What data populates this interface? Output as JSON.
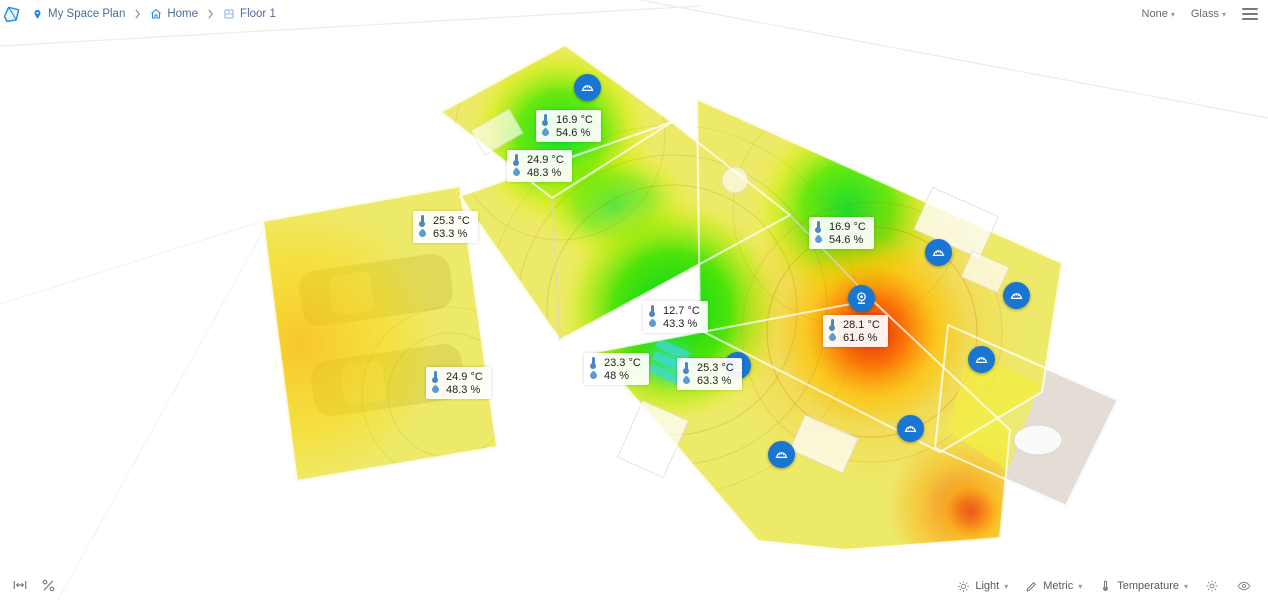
{
  "breadcrumb": {
    "items": [
      {
        "icon": "location-pin-icon",
        "label": "My Space Plan"
      },
      {
        "icon": "home-icon",
        "label": "Home"
      },
      {
        "icon": "floor-icon",
        "label": "Floor 1"
      }
    ]
  },
  "view_controls": {
    "none_dropdown": "None",
    "glass_dropdown": "Glass"
  },
  "toolbar": {
    "light_dropdown": "Light",
    "metric_dropdown": "Metric",
    "temperature_dropdown": "Temperature"
  },
  "sensors": [
    {
      "temperature": "16.9 °C",
      "humidity": "54.6 %",
      "x": 536,
      "y": 110
    },
    {
      "temperature": "24.9 °C",
      "humidity": "48.3 %",
      "x": 507,
      "y": 150
    },
    {
      "temperature": "25.3 °C",
      "humidity": "63.3 %",
      "x": 413,
      "y": 211
    },
    {
      "temperature": "16.9 °C",
      "humidity": "54.6 %",
      "x": 809,
      "y": 217
    },
    {
      "temperature": "12.7 °C",
      "humidity": "43.3 %",
      "x": 643,
      "y": 301
    },
    {
      "temperature": "28.1 °C",
      "humidity": "61.6 %",
      "x": 823,
      "y": 315
    },
    {
      "temperature": "23.3 °C",
      "humidity": "48 %",
      "x": 584,
      "y": 353
    },
    {
      "temperature": "25.3 °C",
      "humidity": "63.3 %",
      "x": 677,
      "y": 358
    },
    {
      "temperature": "24.9 °C",
      "humidity": "48.3 %",
      "x": 426,
      "y": 367
    }
  ],
  "devices": [
    {
      "type": "meter",
      "x": 587,
      "y": 87
    },
    {
      "type": "meter",
      "x": 938,
      "y": 252
    },
    {
      "type": "meter",
      "x": 1016,
      "y": 295
    },
    {
      "type": "webcam",
      "x": 861,
      "y": 298
    },
    {
      "type": "webcam",
      "x": 737,
      "y": 365
    },
    {
      "type": "meter",
      "x": 981,
      "y": 359
    },
    {
      "type": "meter",
      "x": 910,
      "y": 428
    },
    {
      "type": "meter",
      "x": 781,
      "y": 454
    }
  ],
  "colors": {
    "device_blue": "#1976d2",
    "icon_blue": "#1e88e5",
    "breadcrumb_text": "#4b6e96",
    "heat_cold_green": "#00e02a",
    "heat_warm_yellow": "#f2ef3e",
    "heat_hot_red": "#e22508"
  }
}
